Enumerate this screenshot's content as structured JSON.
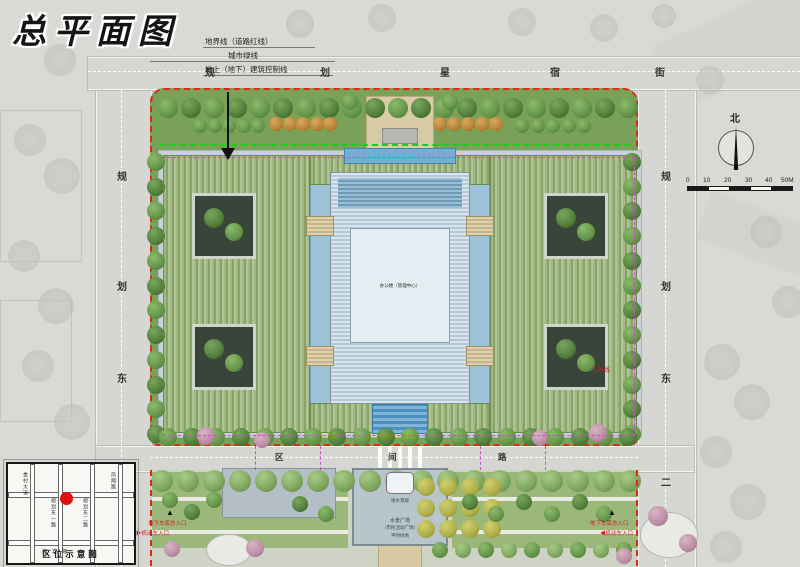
{
  "title": "总平面图",
  "legend": {
    "items": [
      {
        "label": "地界线（道路红线）"
      },
      {
        "label": "城市绿线"
      },
      {
        "label": "地上（地下）建筑控制线"
      }
    ]
  },
  "roads": {
    "top": {
      "name": "规划星宿街",
      "chars": [
        "规",
        "划",
        "星",
        "宿",
        "街"
      ]
    },
    "left": {
      "name": "规划东路",
      "chars": [
        "规",
        "划",
        "东"
      ]
    },
    "right": {
      "name": "规划东二路",
      "chars": [
        "规",
        "划",
        "东",
        "二"
      ]
    },
    "bottom": {
      "name": "区间路",
      "chars": [
        "区",
        "间",
        "路"
      ]
    }
  },
  "site": {
    "main_building_label": "办公楼（管理中心）",
    "fountain_label": "喷水景观",
    "plaza_labels": [
      "水景广场",
      "（市民活动广场）",
      "平时绿地"
    ],
    "east_boundary_label": "东界线"
  },
  "entrances": {
    "garage_left": "地下车库总入口",
    "garage_right": "地下车库总入口",
    "vehicle_left": "▶机动车入口",
    "vehicle_right": "◀机动车入口",
    "arrow_up": "▲"
  },
  "compass": {
    "label": "北"
  },
  "scalebar": {
    "ticks": [
      "0",
      "10",
      "20",
      "30",
      "40",
      "50M"
    ]
  },
  "inset": {
    "caption": "区位示意图",
    "streets": {
      "v1": "金村大道",
      "v2": "规划东一路",
      "v3": "规划东二路",
      "v4": "凤翔路",
      "h1": "迎宾路"
    }
  },
  "colors": {
    "road_red_line": "#e02818",
    "city_green_line": "#1ecc1e",
    "building_control_line": "#c84fc8",
    "water": "#9cc3d7",
    "site_green": "#79a258"
  }
}
